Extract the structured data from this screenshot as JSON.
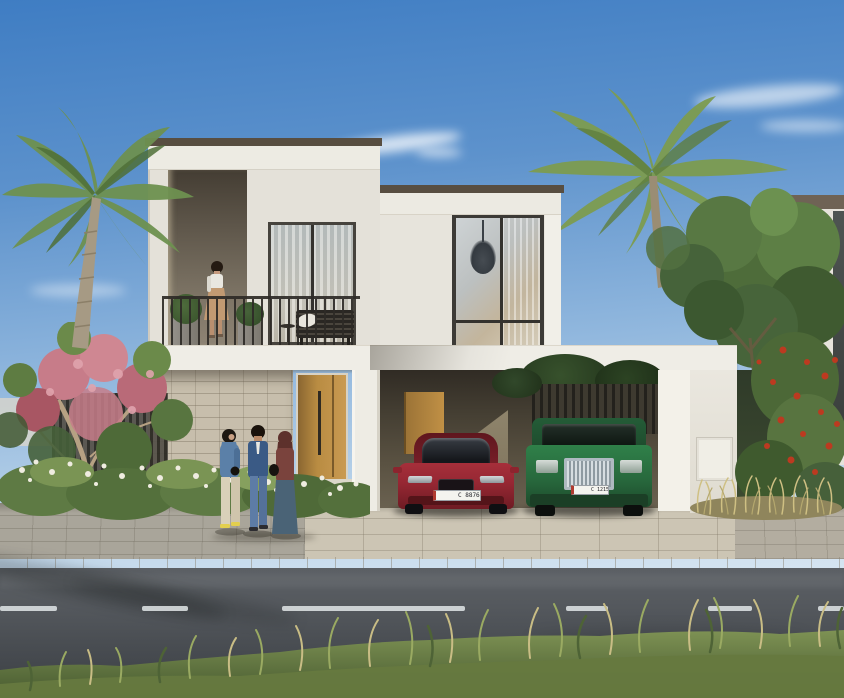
{
  "scene_title": "",
  "vehicles": {
    "sedan": {
      "plate": "C 88764",
      "color": "#a32b35"
    },
    "suv": {
      "plate": "C 12152",
      "color": "#2e7c46"
    }
  },
  "palette": {
    "sky_top": "#3f7dc3",
    "sky_low": "#d8e6f2",
    "wall_white": "#e7e4dc",
    "fascia": "#edebe3",
    "coping": "#584e41",
    "stone": "#c7beac",
    "door_wood": "#b98c42",
    "carport_dark": "#302b24",
    "sedan_red": "#a32b35",
    "suv_green": "#2e7c46",
    "chrome": "#c3ccd2",
    "pavement": "#c6bfae",
    "road": "#53575c",
    "dash": "#e2e6e7",
    "grass_green": "#6f8148",
    "grass_dry": "#c6b97f",
    "palm_green": "#6e9150",
    "tree_green": "#567a3f",
    "pink_flower": "#cf8792",
    "red_flower": "#bc3a20"
  }
}
